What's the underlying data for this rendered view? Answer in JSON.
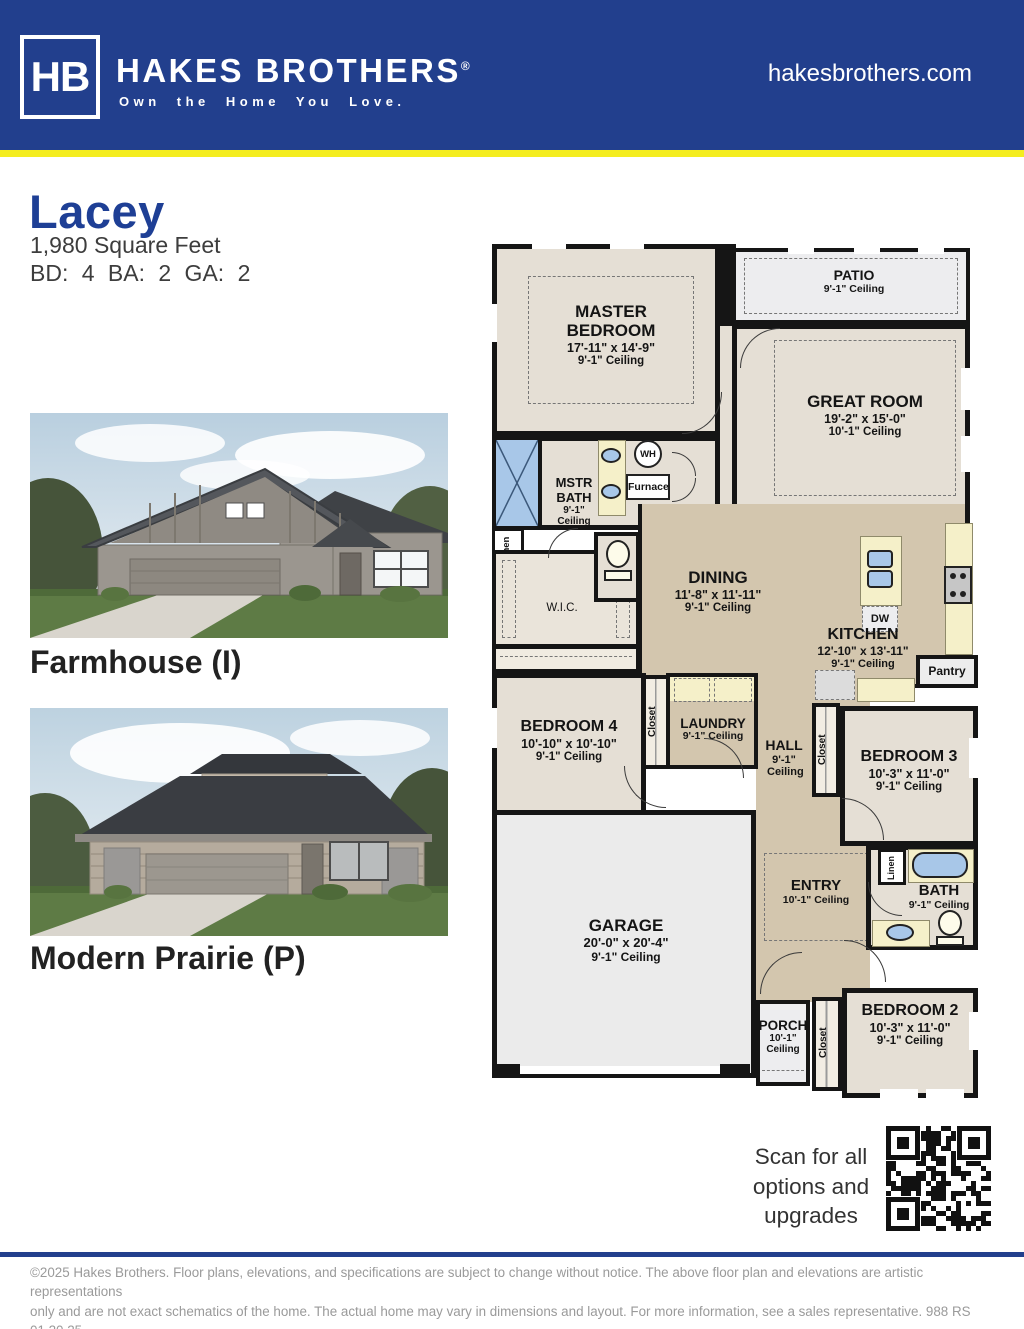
{
  "colors": {
    "navy": "#223F8D",
    "accent_yellow": "#F4ED1F",
    "title_blue": "#1E3F95",
    "room_beige": "#E5DFD5",
    "room_tan": "#D3C6AE"
  },
  "header": {
    "logo": "HB",
    "brand": "HAKES BROTHERS",
    "registered": "®",
    "tagline": "Own the Home You Love.",
    "website": "hakesbrothers.com"
  },
  "plan": {
    "name": "Lacey",
    "sqft": "1,980 Square Feet",
    "specs": "BD: 4  BA: 2  GA: 2"
  },
  "elevations": [
    {
      "label": "Farmhouse (I)"
    },
    {
      "label": "Modern Prairie (P)"
    }
  ],
  "floorplan": {
    "rooms": {
      "master": {
        "name": "MASTER BEDROOM",
        "dims": "17'-11\" x 14'-9\"",
        "ceiling": "9'-1\" Ceiling"
      },
      "patio": {
        "name": "PATIO",
        "ceiling": "9'-1\" Ceiling"
      },
      "great": {
        "name": "GREAT ROOM",
        "dims": "19'-2\" x 15'-0\"",
        "ceiling": "10'-1\" Ceiling"
      },
      "mstrbath": {
        "name": "MSTR BATH",
        "ceiling": "9'-1\" Ceiling"
      },
      "wic": {
        "name": "W.I.C."
      },
      "dining": {
        "name": "DINING",
        "dims": "11'-8\" x 11'-11\"",
        "ceiling": "9'-1\" Ceiling"
      },
      "kitchen": {
        "name": "KITCHEN",
        "dims": "12'-10\" x 13'-11\"",
        "ceiling": "9'-1\" Ceiling"
      },
      "pantry": {
        "name": "Pantry"
      },
      "bedroom4": {
        "name": "BEDROOM 4",
        "dims": "10'-10\" x 10'-10\"",
        "ceiling": "9'-1\" Ceiling"
      },
      "laundry": {
        "name": "LAUNDRY",
        "ceiling": "9'-1\" Ceiling"
      },
      "hall": {
        "name": "HALL",
        "ceiling": "9'-1\" Ceiling"
      },
      "bedroom3": {
        "name": "BEDROOM 3",
        "dims": "10'-3\" x 11'-0\"",
        "ceiling": "9'-1\" Ceiling"
      },
      "garage": {
        "name": "GARAGE",
        "dims": "20'-0\" x 20'-4\"",
        "ceiling": "9'-1\" Ceiling"
      },
      "entry": {
        "name": "ENTRY",
        "ceiling": "10'-1\" Ceiling"
      },
      "bath": {
        "name": "BATH",
        "ceiling": "9'-1\" Ceiling"
      },
      "porch": {
        "name": "PORCH",
        "ceiling": "10'-1\" Ceiling"
      },
      "bedroom2": {
        "name": "BEDROOM 2",
        "dims": "10'-3\" x 11'-0\"",
        "ceiling": "9'-1\" Ceiling"
      }
    },
    "labels": {
      "wh": "WH",
      "furnace": "Furnace",
      "dw": "DW",
      "linen": "Linen",
      "closet": "Closet"
    }
  },
  "qr": {
    "caption": "Scan for all options and upgrades"
  },
  "footer": {
    "line1": "©2025 Hakes Brothers. Floor plans, elevations, and specifications are subject to change without notice. The above floor plan and elevations are artistic representations",
    "line2": "only and are not exact schematics of the home. The actual home may vary in dimensions and layout. For more information, see a sales representative. 988 RS 01.20.25"
  }
}
